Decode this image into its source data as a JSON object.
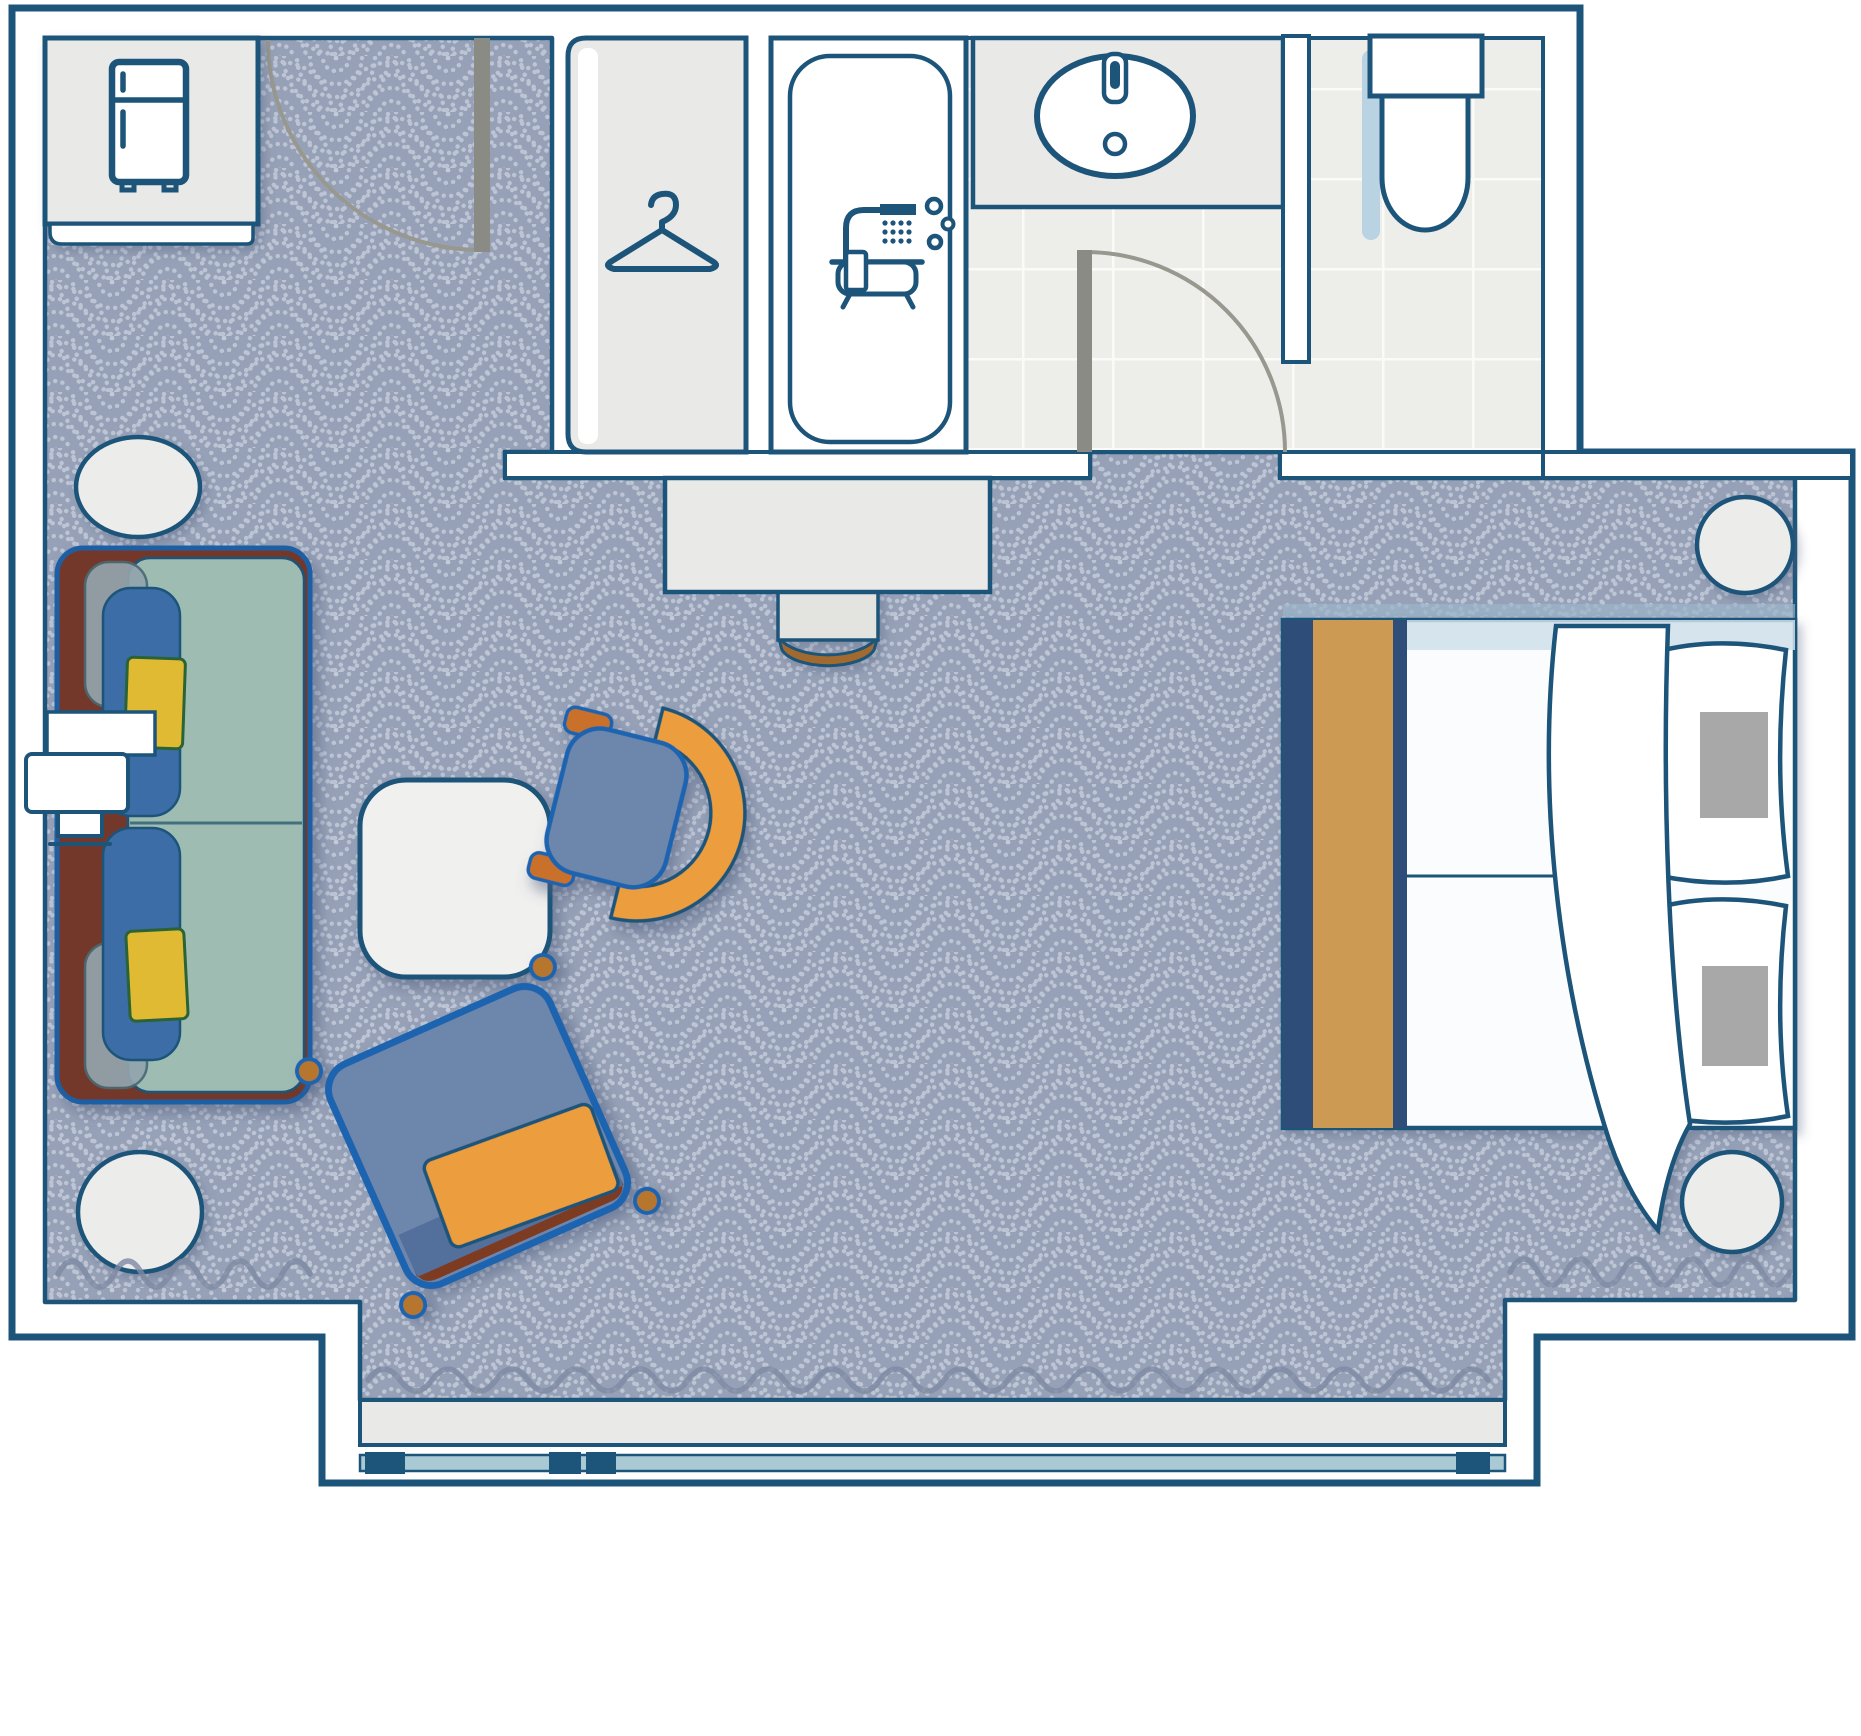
{
  "page": {
    "title": "Hotel guest room floor plan (top-down view)",
    "width_px": 1861,
    "height_px": 1736
  },
  "palette": {
    "wall_stroke": "#1d5479",
    "carpet_base": "#96a1b7",
    "carpet_dots": "#c3cada",
    "tile_fill": "#ededea",
    "tile_grout": "#fafaf8",
    "fixture_gray": "#e9e9e7",
    "upholstery_outline": "#1a63b0",
    "chair_blue": "#6d86ac",
    "sofa_teal": "#9fbcb2",
    "sofa_frame_brown": "#73392b",
    "bolster_blue": "#3c6da6",
    "pillow_yellow": "#e0ba33",
    "accent_orange": "#ec9d3e",
    "bed_runner_tan": "#cd9a52",
    "bed_frame_navy": "#2e4d78",
    "soft_shadow_blue": "#b9d3e2",
    "window_glass_blue": "#a9c9d4",
    "door_leaf_gray": "#8b8b85"
  },
  "rooms": {
    "main": {
      "label": "Bedroom and sitting area",
      "floor": "patterned carpet"
    },
    "bathroom": {
      "label": "Bathroom",
      "floor": "ceramic tile"
    },
    "closet": {
      "label": "Wardrobe closet"
    },
    "balcony": {
      "label": "Window wall with glazing track"
    }
  },
  "fixtures": {
    "entry_door": {
      "label": "Entry door with swing arc"
    },
    "bathroom_door": {
      "label": "Bathroom door with swing arc"
    },
    "minibar_counter": {
      "label": "Minibar counter with refrigerator"
    },
    "wardrobe": {
      "label": "Closet with clothes hanger symbol"
    },
    "bathtub": {
      "label": "Bathtub enclosure with shower-bath symbol"
    },
    "sink": {
      "label": "Vanity counter with oval basin and faucet"
    },
    "toilet": {
      "label": "Toilet with tank"
    },
    "partition": {
      "label": "Partition wall between vanity and toilet"
    },
    "desk": {
      "label": "Console desk with stool"
    },
    "window_track": {
      "label": "Sliding window track"
    }
  },
  "furniture": {
    "sofa": {
      "label": "Sofa with teal cushions, blue bolster and two yellow pillows"
    },
    "tv": {
      "label": "Wall-mounted TV with shelf"
    },
    "coffee_table": {
      "label": "Square coffee table"
    },
    "lounge_chair": {
      "label": "Lounge chair with orange shell and blue seat"
    },
    "accent_chair": {
      "label": "Square accent chair with orange lumbar pillow"
    },
    "bed": {
      "label": "Double bed with duvet, folded blanket, tan runner and two pillows"
    },
    "side_table_top_left": {
      "label": "Round side table"
    },
    "side_table_bottom_left": {
      "label": "Round side table"
    },
    "nightstand_top": {
      "label": "Round nightstand"
    },
    "nightstand_bottom": {
      "label": "Round nightstand"
    }
  },
  "icons": {
    "refrigerator": {
      "name": "refrigerator-icon"
    },
    "hanger": {
      "name": "hanger-icon"
    },
    "shower_bath": {
      "name": "shower-bath-icon"
    },
    "faucet": {
      "name": "faucet-icon"
    }
  }
}
